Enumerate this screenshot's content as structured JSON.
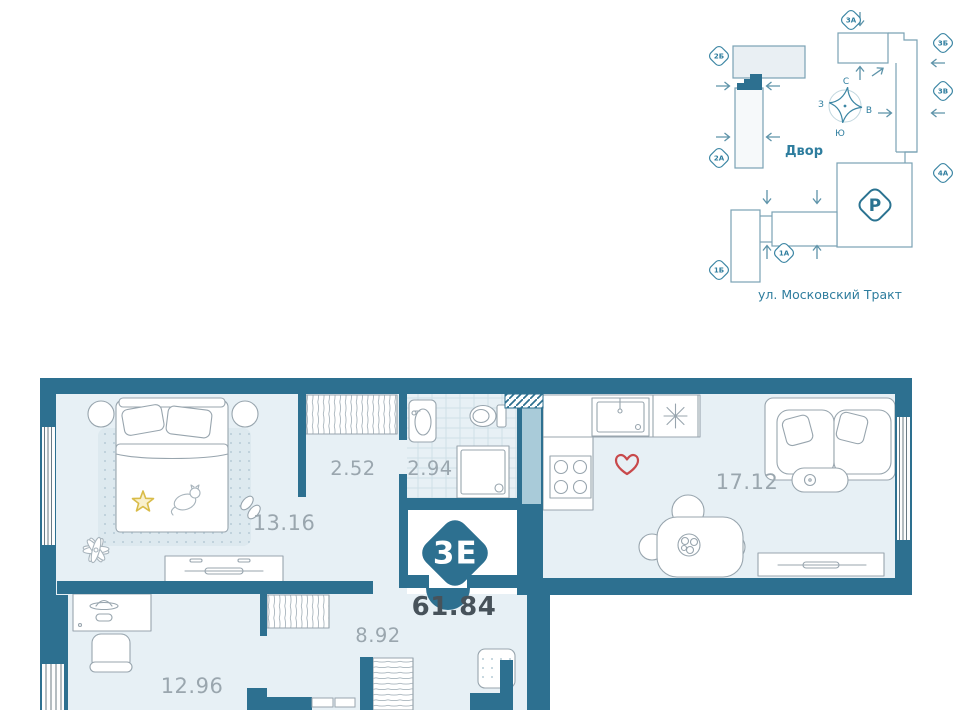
{
  "site_plan": {
    "courtyard_label": "Двор",
    "street_label": "ул. Московский Тракт",
    "parking_label": "Р",
    "compass": {
      "north": "С",
      "south": "Ю",
      "west": "З",
      "east": "В"
    },
    "badges": [
      "2Б",
      "2А",
      "3А",
      "3Б",
      "3В",
      "4А",
      "1А",
      "1Б"
    ]
  },
  "floor_plan": {
    "unit_type_badge": "3Е",
    "total_area": "61.84",
    "room_areas": {
      "bedroom": "13.16",
      "hallway": "2.52",
      "bathroom": "2.94",
      "kitchen_living": "17.12",
      "corridor": "8.92",
      "cabinet": "12.96"
    }
  },
  "colors": {
    "wall": "#2d7090",
    "room_fill": "#e7f0f5",
    "duct_fill": "#a9cbd9",
    "accent_red": "#c8494b",
    "accent_yellow": "#d9bc49",
    "site_line": "#7aa2b4",
    "site_text": "#2e7d9e",
    "area_text": "#9aa6ae",
    "total_text": "#47525a"
  }
}
